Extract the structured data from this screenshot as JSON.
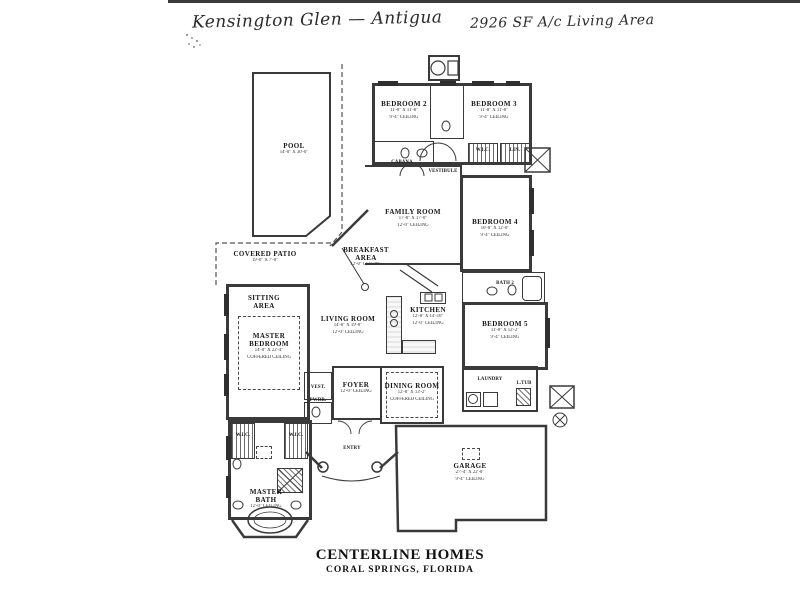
{
  "header": {
    "title_left": "Kensington Glen — Antigua",
    "title_right": "2926 SF A/c Living Area"
  },
  "footer": {
    "builder": "CENTERLINE HOMES",
    "location": "CORAL SPRINGS, FLORIDA"
  },
  "rooms": {
    "pool": {
      "name": "POOL",
      "dims": "14'-0\" X 30'-0\""
    },
    "covered_patio": {
      "name": "COVERED PATIO",
      "dims": "19'-0\" X 7'-0\""
    },
    "sitting": {
      "name": "SITTING AREA"
    },
    "master_bedroom": {
      "name": "MASTER BEDROOM",
      "dims": "14'-0\" X 22'-4\"",
      "ceiling": "COFFERED CEILING"
    },
    "master_bath": {
      "name": "MASTER BATH",
      "ceiling": "12'-0\" CEILING"
    },
    "bedroom2": {
      "name": "BEDROOM 2",
      "dims": "11'-8\" X 11'-8\"",
      "ceiling": "9'-4\" CEILING"
    },
    "bedroom3": {
      "name": "BEDROOM 3",
      "dims": "11'-8\" X 11'-8\"",
      "ceiling": "9'-4\" CEILING"
    },
    "bedroom4": {
      "name": "BEDROOM 4",
      "dims": "10'-8\" X 12'-0\"",
      "ceiling": "9'-4\" CEILING"
    },
    "bedroom5": {
      "name": "BEDROOM 5",
      "dims": "11'-8\" X 12'-2\"",
      "ceiling": "9'-4\" CEILING"
    },
    "family": {
      "name": "FAMILY ROOM",
      "dims": "17'-8\" X 17'-0\"",
      "ceiling": "12'-0\" CEILING"
    },
    "breakfast": {
      "name": "BREAKFAST AREA",
      "ceiling": "12'-0\" CEILING"
    },
    "living": {
      "name": "LIVING ROOM",
      "dims": "14'-8\" X 19'-8\"",
      "ceiling": "12'-0\" CEILING"
    },
    "kitchen": {
      "name": "KITCHEN",
      "dims": "12'-8\" X 14'-10\"",
      "ceiling": "12'-0\" CEILING"
    },
    "dining": {
      "name": "DINING ROOM",
      "dims": "12'-8\" X 13'-2\"",
      "ceiling": "COFFERED CEILING"
    },
    "foyer": {
      "name": "FOYER",
      "ceiling": "12'-0\" CEILING"
    },
    "vestibule": {
      "name": "VESTIBULE"
    },
    "vest": {
      "name": "VEST."
    },
    "pwdr": {
      "name": "PWDR."
    },
    "entry": {
      "name": "ENTRY"
    },
    "cabana": {
      "name": "CABANA"
    },
    "bath2": {
      "name": "BATH 2"
    },
    "laundry": {
      "name": "LAUNDRY"
    },
    "garage": {
      "name": "GARAGE",
      "dims": "27'-4\" X 22'-0\"",
      "ceiling": "9'-4\" CEILING"
    },
    "wic1": {
      "name": "W.I.C."
    },
    "wic2": {
      "name": "W.I.C."
    },
    "wic3": {
      "name": "W.I.C."
    },
    "lin": {
      "name": "LIN."
    },
    "ltub": {
      "name": "L.TUB"
    }
  }
}
